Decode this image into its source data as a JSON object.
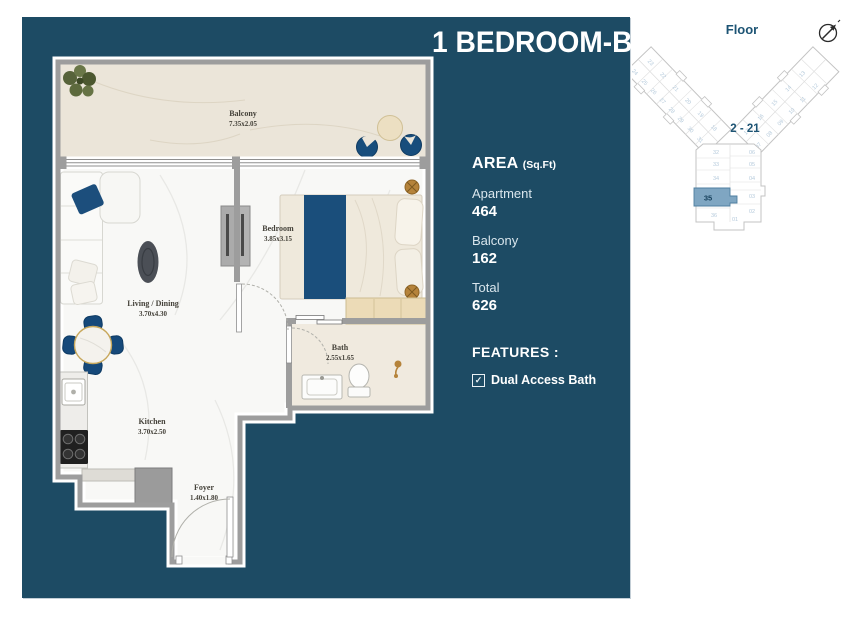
{
  "title": "1 BEDROOM-B",
  "area_panel": {
    "heading": "AREA",
    "heading_unit": "(Sq.Ft)",
    "rows": [
      {
        "label": "Apartment",
        "value": "464"
      },
      {
        "label": "Balcony",
        "value": "162"
      },
      {
        "label": "Total",
        "value": "626"
      }
    ],
    "features_heading": "FEATURES :",
    "features": [
      {
        "label": "Dual Access Bath",
        "checked": true,
        "checkbox_glyph": "✓"
      }
    ]
  },
  "floor_plan": {
    "rooms": [
      {
        "name": "Balcony",
        "dims": "7.35x2.05"
      },
      {
        "name": "Bedroom",
        "dims": "3.85x3.15"
      },
      {
        "name": "Living / Dining",
        "dims": "3.70x4.30"
      },
      {
        "name": "Bath",
        "dims": "2.55x1.65"
      },
      {
        "name": "Kitchen",
        "dims": "3.70x2.50"
      },
      {
        "name": "Foyer",
        "dims": "1.40x1.80"
      }
    ]
  },
  "key_plan": {
    "label": "Floor",
    "floor_range": "2 - 21",
    "highlighted_unit": "35",
    "left_wing_units": [
      "23",
      "22",
      "21",
      "20",
      "19",
      "18",
      "24",
      "25",
      "26",
      "27",
      "28",
      "29",
      "30",
      "31"
    ],
    "right_wing_units": [
      "17",
      "16",
      "15",
      "14",
      "13",
      "07",
      "08",
      "09",
      "10",
      "11",
      "12"
    ],
    "stem_units_left": [
      "32",
      "33",
      "34",
      "36"
    ],
    "stem_units_right": [
      "06",
      "05",
      "04",
      "03",
      "02"
    ],
    "stem_unit_bottom": "01",
    "compass_icon": "north-arrow"
  },
  "colors": {
    "panel_teal": "#1d4b64",
    "navy_accent": "#174d7c",
    "gold": "#b5833b",
    "balcony_cream": "#ebe5d9",
    "wall_gray": "#9d9d9d",
    "key_highlight": "#7fa6c2",
    "key_text_teal": "#1d5474"
  }
}
